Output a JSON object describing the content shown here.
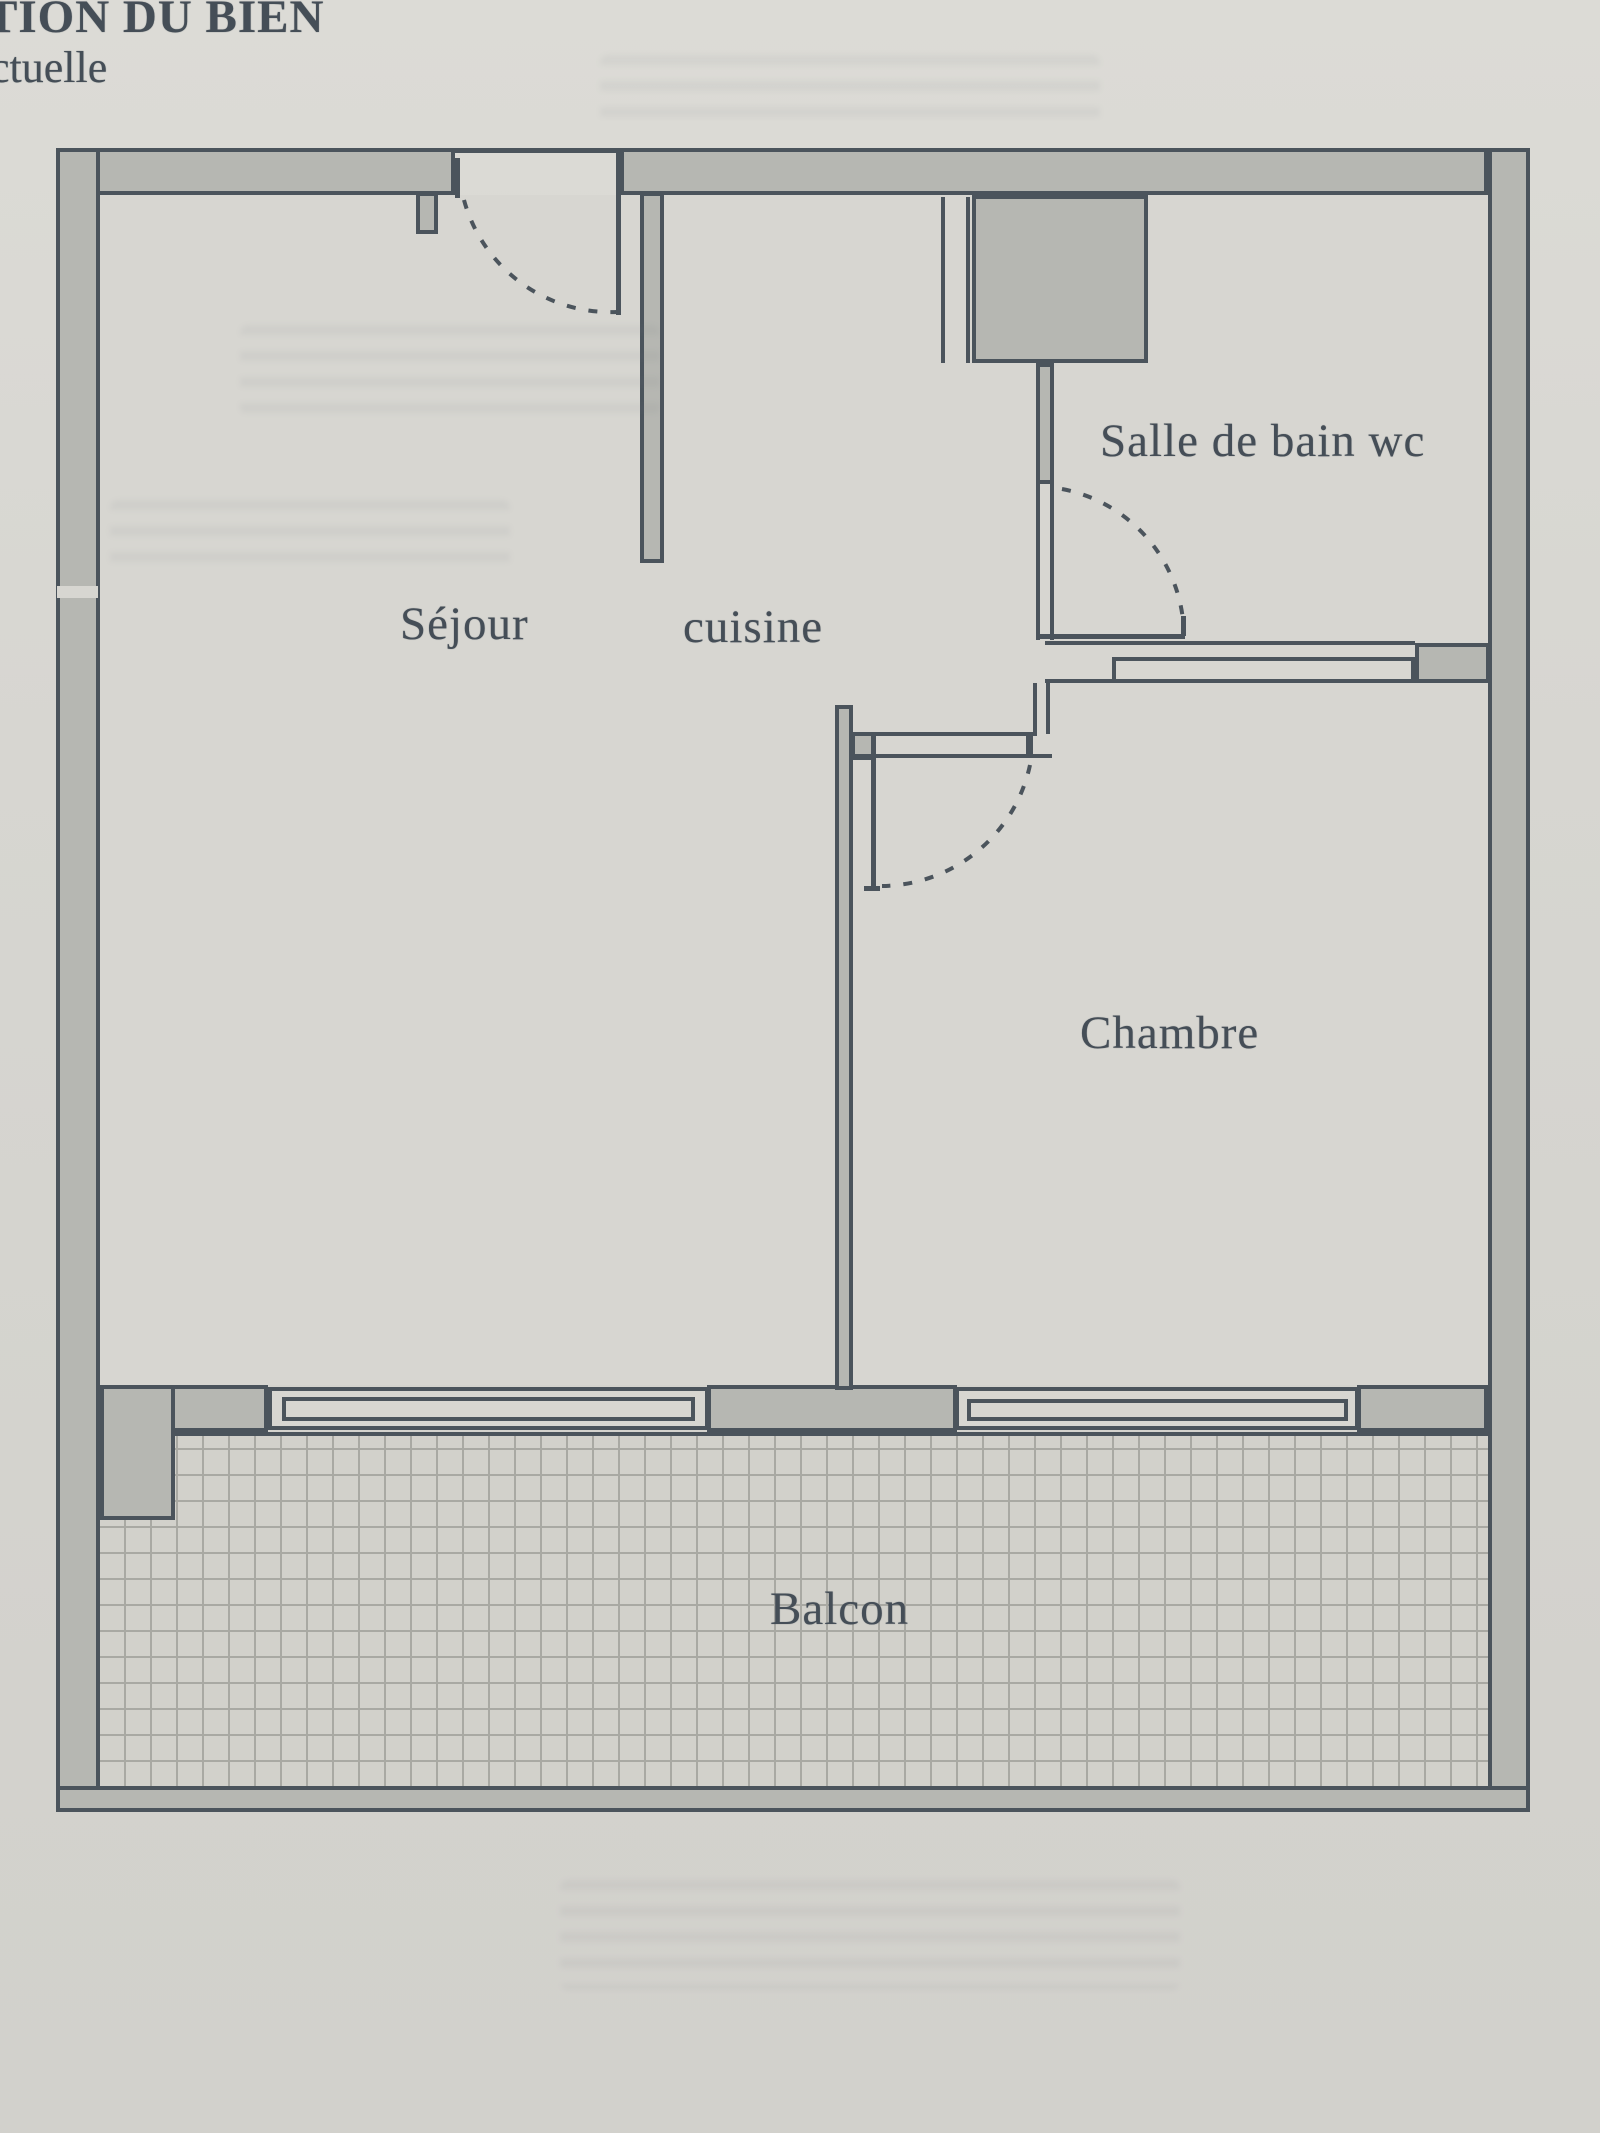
{
  "page": {
    "paper_color": "#d7d6d1"
  },
  "header": {
    "line1": "TION DU BIEN",
    "line2": "ctuelle",
    "text_color": "#3e474f"
  },
  "floorplan": {
    "outline_color": "#4b545c",
    "wall_fill": "#b6b7b2",
    "floor_fill": "#d7d6d1",
    "balcony_floor_fill": "#d2d1cb",
    "grid_line_color": "#a9a9a3",
    "label_color": "#454e57",
    "rooms": [
      {
        "id": "sejour",
        "label": "Séjour"
      },
      {
        "id": "cuisine",
        "label": "cuisine"
      },
      {
        "id": "salle_de_bain",
        "label": "Salle de bain wc"
      },
      {
        "id": "chambre",
        "label": "Chambre"
      },
      {
        "id": "balcon",
        "label": "Balcon"
      }
    ],
    "features": {
      "doors": [
        "entry-door",
        "bathroom-door",
        "bedroom-door"
      ],
      "windows": [
        "sejour-window",
        "chambre-window",
        "bathroom-transom-window"
      ]
    }
  }
}
